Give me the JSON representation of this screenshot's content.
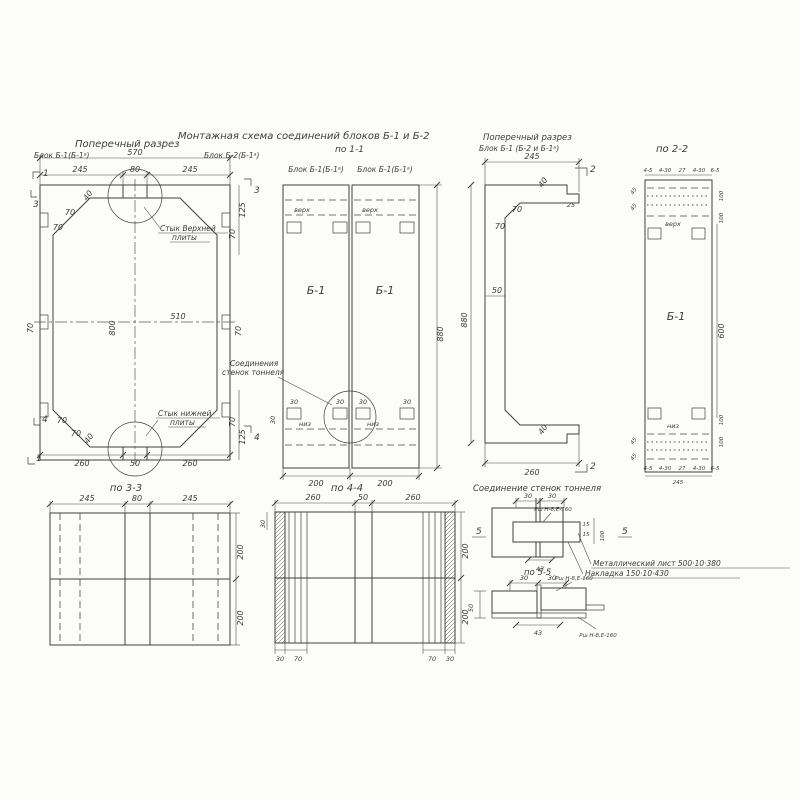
{
  "palette": {
    "ink": "#3d3d3d",
    "paper": "#fcfcfa"
  },
  "titles": {
    "plan_title": "Поперечный разрез",
    "plan_block_a": "Блок Б-1(Б-1ᵃ)",
    "plan_block_b": "Блок Б-2(Б-1ᵃ)",
    "assembly_title": "Монтажная схема соединений блоков Б-1 и Б-2",
    "assembly_section": "по 1-1",
    "assembly_panel_a": "Блок Б-1(Б-1ᵃ)",
    "assembly_panel_b": "Блок Б-1(Б-1ᵃ)",
    "channel_title_1": "Поперечный разрез",
    "channel_title_2": "Блок Б-1 (Б-2 и Б-1ᵃ)",
    "section_22": "по 2-2",
    "section_33": "по 3-3",
    "section_44": "по 4-4",
    "joint_title": "Соединение стенок тоннеля",
    "section_55": "по 5-5"
  },
  "plan": {
    "w_total": "570",
    "w_left": "245",
    "w_mid": "80",
    "w_right": "245",
    "b_left": "260",
    "b_mid": "50",
    "b_right": "260",
    "h_inner": "800",
    "w_inner": "510",
    "d40": "40",
    "d70": "70",
    "d125": "125",
    "mark_1": "1",
    "mark_3": "3",
    "mark_4": "4",
    "top_joint_1": "Стык Верхней",
    "top_joint_2": "плиты",
    "bot_joint_1": "Стык нижней",
    "bot_joint_2": "плиты"
  },
  "assembly": {
    "verh": "верх",
    "niz": "низ",
    "block": "Б-1",
    "callout_1": "Соединения",
    "callout_2": "стенок тоннеля",
    "d30": "30",
    "h_total": "880",
    "w_panel": "200"
  },
  "channel": {
    "w_top": "245",
    "w_bot": "260",
    "h_total": "880",
    "d40": "40",
    "d25": "25",
    "d70": "70",
    "d50": "50",
    "mark_2": "2"
  },
  "sec22": {
    "block": "Б-1",
    "verh": "верх",
    "niz": "низ",
    "dim_a": "4-5",
    "dim_b": "4-30",
    "dim_c": "27",
    "dim_d": "4-30",
    "dim_e": "6-5",
    "d45": "45",
    "d100": "100",
    "h_mid": "600",
    "w_total": "245"
  },
  "sec33": {
    "w_left": "245",
    "w_mid": "80",
    "w_right": "245",
    "h_top": "200",
    "h_bot": "200"
  },
  "sec44": {
    "w_left": "260",
    "w_mid": "50",
    "w_right": "260",
    "h_top": "200",
    "h_bot": "200",
    "d30": "30",
    "d70": "70"
  },
  "joint": {
    "d30a": "30",
    "d30b": "30",
    "d43": "43",
    "d15": "15",
    "d100": "100",
    "mark_5": "5",
    "weld": "Рш Н-8,Е-160",
    "sheet_note": "Металлический лист 500·10·380",
    "strap_note": "Накладка 150·10·430"
  },
  "sec55": {
    "d30a": "30",
    "d30b": "30",
    "d43": "43",
    "d50": "50",
    "weld": "Рш Н-8,Е-160"
  }
}
